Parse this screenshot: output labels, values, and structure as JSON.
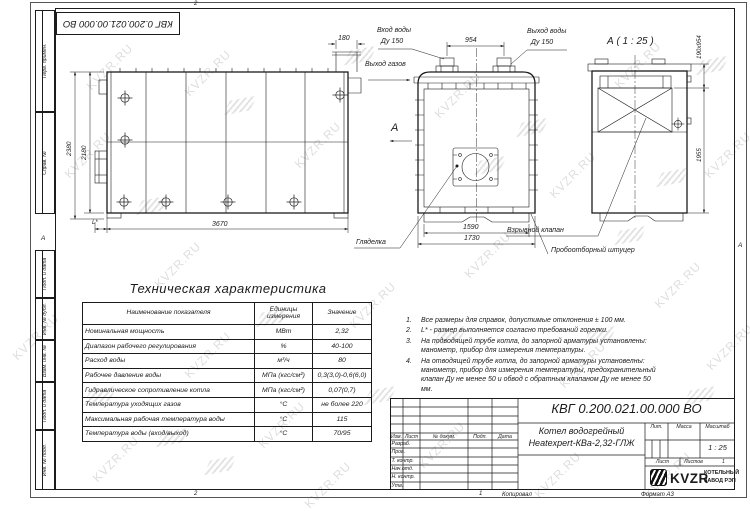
{
  "sheet": {
    "designation": "КВГ 0.200.021.00.000 ВО",
    "watermark": "KVZR.RU",
    "zone_top": "2",
    "zone_bottom_left": "2",
    "zone_bottom_right": "1",
    "zone_left": "А",
    "zone_right": "А",
    "margin_stamps": [
      "Перв. примен.",
      "Справ. №",
      "Подп. и дата",
      "Инв. № дубл.",
      "Взам. инв. №",
      "Подп. и дата",
      "Инв. № подл."
    ]
  },
  "views": {
    "side": {
      "dim_total_height": "2380",
      "dim_body_height": "2180",
      "dim_length": "3670",
      "dim_flue_width": "180",
      "dim_burner": "L*"
    },
    "front": {
      "label_water_inlet": "Вход воды",
      "label_water_inlet_dn": "Ду 150",
      "label_water_outlet": "Выход воды",
      "label_water_outlet_dn": "Ду 150",
      "label_gas_outlet": "Выход газов",
      "dim_nozzle_spacing": "954",
      "dim_inner_width": "1590",
      "dim_outer_width": "1730",
      "section_arrow": "А",
      "label_sight_glass": "Гляделка",
      "label_explosion_valve": "Взрывной клапан",
      "label_sampling_fitting": "Пробоотборный штуцер"
    },
    "detail": {
      "title": "А ( 1 : 25 )",
      "dim_flue_outlet": "190х954",
      "dim_height": "1955"
    }
  },
  "spec_table": {
    "title": "Техническая характеристика",
    "headers": [
      "Наименование показателя",
      "Единицы измерения",
      "Значение"
    ],
    "rows": [
      [
        "Номинальная мощность",
        "МВт",
        "2,32"
      ],
      [
        "Диапазон рабочего регулирования",
        "%",
        "40-100"
      ],
      [
        "Расход воды",
        "м³/ч",
        "80"
      ],
      [
        "Рабочее давление воды",
        "МПа (кгс/см²)",
        "0,3(3,0)-0,6(6,0)"
      ],
      [
        "Гидравлическое сопротивление котла",
        "МПа (кгс/см²)",
        "0,07(0,7)"
      ],
      [
        "Температура уходящих газов",
        "°С",
        "не более 220"
      ],
      [
        "Максимальная рабочая температура воды",
        "°С",
        "115"
      ],
      [
        "Температура воды (вход/выход)",
        "°С",
        "70/95"
      ]
    ]
  },
  "notes": [
    {
      "n": "1.",
      "text": "Все размеры для справок, допустимые отклонения ± 100 мм."
    },
    {
      "n": "2.",
      "text": "L* - размер выполняется согласно требований горелки."
    },
    {
      "n": "3.",
      "text": "На подводящей трубе котла, до запорной арматуры установлены: манометр, прибор для измерения температуры."
    },
    {
      "n": "4.",
      "text": "На отводящей трубе котла, до запорной арматуры установелны: манометр, прибор для измерения температуры, предохранительный клапан Ду не менее 50 и обвод с обратным клапаном Ду не менее 50 мм."
    }
  ],
  "title_block": {
    "designation": "КВГ 0.200.021.00.000 ВО",
    "product_name_1": "Котел водогрейный",
    "product_name_2": "Heatexpert-КВа-2,32-ГЛЖ",
    "rev_headers": [
      "Изм.",
      "Лист",
      "№ докум.",
      "Подп.",
      "Дата"
    ],
    "sign_rows": [
      "Разраб.",
      "Пров.",
      "Т. контр.",
      "Нач.отд.",
      "Н. контр.",
      "Утв."
    ],
    "lit_label": "Лит.",
    "mass_label": "Масса",
    "scale_label": "Масштаб",
    "scale_value": "1 : 25",
    "sheet_label": "Лист",
    "sheets_label": "Листов",
    "sheets_value": "1",
    "logo_text": "KVZR",
    "logo_line1": "КОТЕЛЬНЫЙ",
    "logo_line2": "ЗАВОД РЭП",
    "copied_label": "Копировал",
    "format_label": "Формат А3"
  }
}
